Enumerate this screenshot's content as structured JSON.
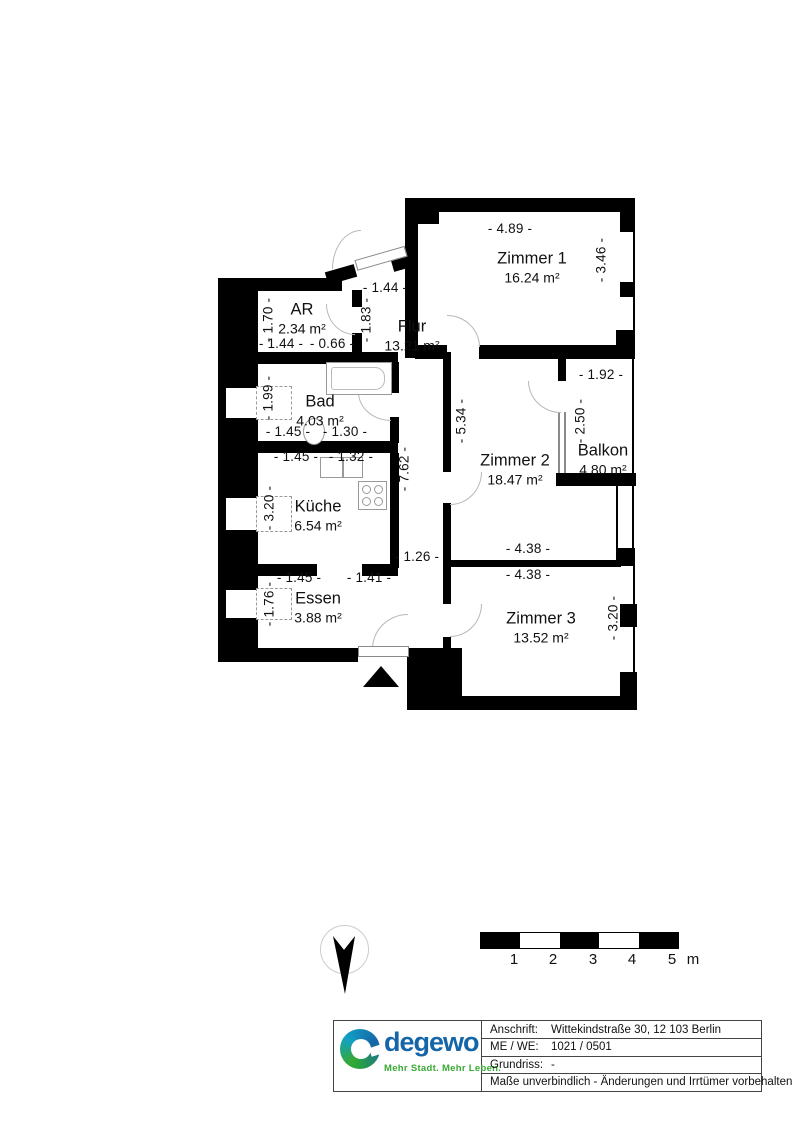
{
  "plan": {
    "rooms": [
      {
        "name": "Zimmer 1",
        "area": "16.24 m²"
      },
      {
        "name": "AR",
        "area": "2.34 m²"
      },
      {
        "name": "Flur",
        "area": "13.21 m²"
      },
      {
        "name": "Bad",
        "area": "4.03 m²"
      },
      {
        "name": "Küche",
        "area": "6.54 m²"
      },
      {
        "name": "Essen",
        "area": "3.88 m²"
      },
      {
        "name": "Zimmer 2",
        "area": "18.47 m²"
      },
      {
        "name": "Balkon",
        "area": "4.80 m²"
      },
      {
        "name": "Zimmer 3",
        "area": "13.52 m²"
      }
    ],
    "dims": [
      "- 4.89 -",
      "- 3.46 -",
      "- 1.44 -",
      "- 1.70 -",
      "- 1.83 -",
      "- 1.44 -",
      "- 0.66 -",
      "- 1.99 -",
      "- 1.45 -",
      "- 1.30 -",
      "- 1.45 -",
      "- 1.32 -",
      "- 3.20 -",
      "- 7.62 -",
      "- 5.34 -",
      "- 1.26 -",
      "- 1.45 -",
      "- 1.41 -",
      "- 1.76 -",
      "- 1.92 -",
      "- 2.50 -",
      "- 4.38 -",
      "- 4.38 -",
      "- 3.20 -"
    ],
    "wall_color": "#000000"
  },
  "scale_bar": {
    "ticks": [
      "1",
      "2",
      "3",
      "4",
      "5"
    ],
    "unit": "m"
  },
  "title_block": {
    "rows": [
      {
        "label": "Anschrift:",
        "value": "Wittekindstraße 30, 12 103 Berlin"
      },
      {
        "label": "ME / WE:",
        "value": "1021 / 0501"
      },
      {
        "label": "Grundriss:",
        "value": "-"
      }
    ],
    "disclaimer": "Maße unverbindlich - Änderungen und Irrtümer vorbehalten"
  },
  "logo": {
    "wordmark": "degewo",
    "tagline": "Mehr Stadt. Mehr Leben.",
    "blue": "#1566a9",
    "green": "#3aaa35"
  }
}
